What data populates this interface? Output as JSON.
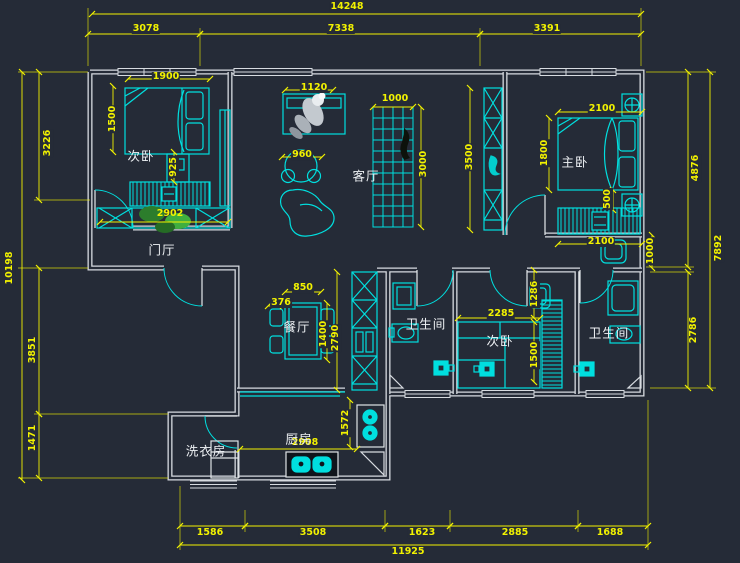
{
  "app": {
    "type": "cad-floor-plan",
    "background": "#252b37"
  },
  "colors": {
    "wall": "#d7dbe0",
    "furniture": "#00dfdf",
    "dimension": "#f2f200",
    "room_label": "#eef1f4",
    "plant": "#2c7d2c"
  },
  "rooms": {
    "bedroom_left": "次卧",
    "entry": "门厅",
    "living": "客厅",
    "master": "主卧",
    "dining": "餐厅",
    "bath_mid": "卫生间",
    "bedroom_mid": "次卧",
    "bath_right": "卫生间",
    "kitchen": "厨房",
    "laundry": "洗衣房"
  },
  "dims": {
    "top_total": "14248",
    "top_1": "3078",
    "top_2": "7338",
    "top_3": "3391",
    "left_1": "3226",
    "left_total": "10198",
    "left_2": "3851",
    "left_3": "1471",
    "right_1": "4876",
    "right_total": "7892",
    "right_2": "2786",
    "bottom_1": "1586",
    "bottom_2": "3508",
    "bottom_3": "1623",
    "bottom_4": "2885",
    "bottom_5": "1688",
    "bottom_total": "11925",
    "bed1_width": "1900",
    "bed1_depth": "1500",
    "nightstand1": "925",
    "closet1": "2902",
    "tv_unit": "1120",
    "round_chair": "960",
    "shelf_width": "1000",
    "shelf_height": "3000",
    "column_height": "3500",
    "master_bed_width": "2100",
    "master_bed_depth": "1800",
    "gap_500": "500",
    "master_closet": "2100",
    "corridor_1000": "1000",
    "dining_table": "850",
    "dining_chair": "376",
    "dining_depth": "1400",
    "dining_column": "2790",
    "bed2_width": "2285",
    "desk2": "1286",
    "bed2_depth": "1500",
    "kitchen_width": "2908",
    "kitchen_depth": "1572"
  }
}
